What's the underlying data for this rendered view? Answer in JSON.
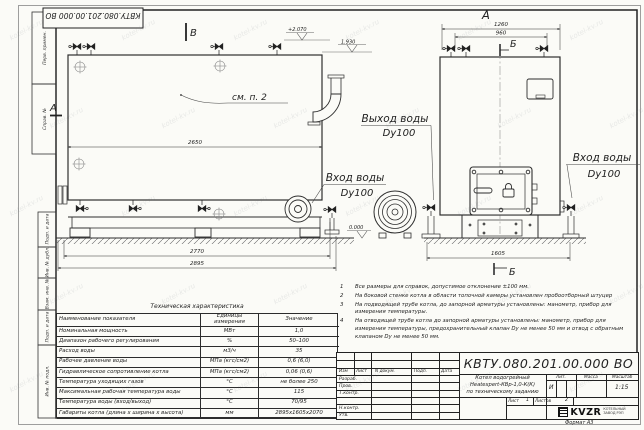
{
  "sheet": {
    "top_stamp": "КВТУ.080.201.00.000 ВО",
    "format_note": "Формат  А3",
    "watermark": "kotel-kv.ru",
    "side_labels": [
      "Перв. примен.",
      "Справ. №",
      "Подп. и дата",
      "Инв. № дубл.",
      "Взам. инв. №",
      "Подп. и дата",
      "Инв. № подл."
    ]
  },
  "views": {
    "label_front": "А",
    "label_b": "В",
    "section_a": "А",
    "section_b_top": "Б",
    "section_b_bottom": "Б",
    "see_note": "см. п. 2",
    "elev_2070": "+2.070",
    "elev_1930": "1.930",
    "elev_0": "0.000",
    "dim_2650": "2650",
    "dim_2770": "2770",
    "dim_2895": "2895",
    "dim_1260": "1260",
    "dim_960": "960",
    "dim_1605": "1605",
    "water_out_1": "Выход воды",
    "water_out_2": "Dy100",
    "water_in_left_1": "Вход воды",
    "water_in_left_2": "Dy100",
    "water_in_right_1": "Вход воды",
    "water_in_right_2": "Dy100"
  },
  "notes": [
    {
      "n": "1",
      "t": "Все размеры для справок, допустимое отклонение ±100 мм."
    },
    {
      "n": "2",
      "t": "На боковой стенке котла в области топочной камеры установлен пробоотборный штуцер"
    },
    {
      "n": "3",
      "t": "На  подводящей трубе котла, до запорной арматуры установлены: манометр, прибор для измерения температуры."
    },
    {
      "n": "4",
      "t": "На отводящей трубе котла до запорной арматуры установлены: манометр, прибор для измерения температуры, предохранительный клапан Dу не менее 50 мм и отвод с обратным клапаном Dу не менее 50 мм."
    }
  ],
  "tech_table": {
    "title": "Техническая характеристика",
    "col_name": "Наименование показателя",
    "col_units": "Единицы измерения",
    "col_value": "Значение",
    "rows": [
      {
        "name": "Номинальная мощность",
        "units": "МВт",
        "value": "1,0"
      },
      {
        "name": "Диапазон рабочего регулирования",
        "units": "%",
        "value": "50–100"
      },
      {
        "name": "Расход воды",
        "units": "м3/ч",
        "value": "35"
      },
      {
        "name": "Рабочее давление воды",
        "units": "МПа (кгс/см2)",
        "value": "0,6 (6,0)"
      },
      {
        "name": "Гидравлическое сопротивление котла",
        "units": "МПа (кгс/см2)",
        "value": "0,06 (0,6)"
      },
      {
        "name": "Температура уходящих газов",
        "units": "°С",
        "value": "не более 250"
      },
      {
        "name": "Максимальная рабочая температура воды",
        "units": "°С",
        "value": "115"
      },
      {
        "name": "Температура воды (вход/выход)",
        "units": "°С",
        "value": "70/95"
      },
      {
        "name": "Габариты котла (длина х ширина х высота)",
        "units": "мм",
        "value": "2895х1605х2070"
      }
    ]
  },
  "title_block": {
    "doc_number": "КВТУ.080.201.00.000  ВО",
    "header_cols": [
      "Изм",
      "Лист",
      "N докум.",
      "Подп.",
      "Дата"
    ],
    "sig_rows": [
      "Разраб.",
      "Пров.",
      "Т.контр.",
      "Н.контр.",
      "Утв."
    ],
    "name_lines": [
      "Котел водогрейный",
      "Heatexpert-КВр-1,0-К(К)",
      "по техническому заданию"
    ],
    "lit_label": "Лит.",
    "mass_label": "Масса",
    "scale_label": "Масштаб",
    "lit_value": "И",
    "scale_value": "1:15",
    "sheet_label": "Лист",
    "sheet_value": "1",
    "sheets_label": "Листов",
    "sheets_value": "2",
    "company": "KVZR",
    "company_sub1": "КОТЕЛЬНЫЙ",
    "company_sub2": "ЗАВОД РЭП"
  }
}
